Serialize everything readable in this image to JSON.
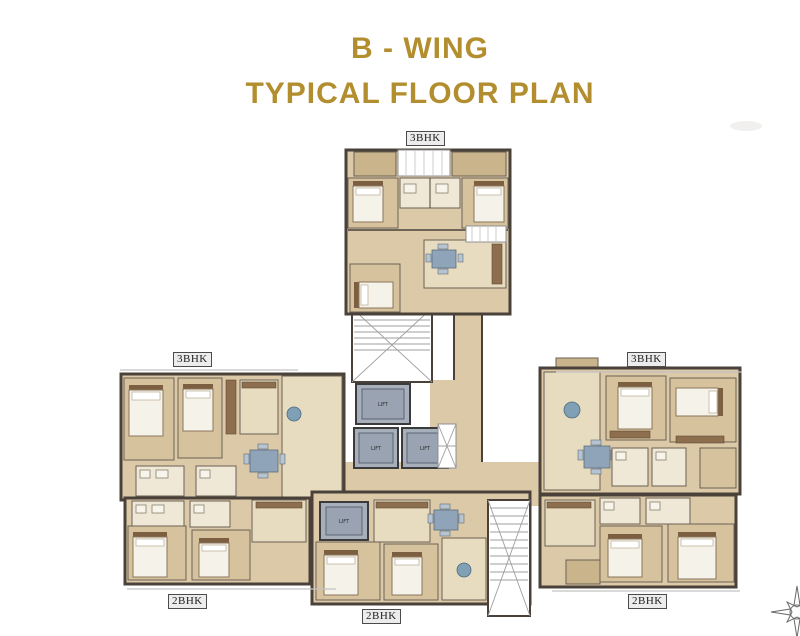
{
  "title": {
    "line1": "B - WING",
    "line2": "TYPICAL FLOOR PLAN",
    "color": "#B28E2E"
  },
  "plan": {
    "units": [
      {
        "key": "top",
        "type_label": "3BHK"
      },
      {
        "key": "left",
        "type_label": "3BHK"
      },
      {
        "key": "right",
        "type_label": "3BHK"
      },
      {
        "key": "bottom_left",
        "type_label": "2BHK"
      },
      {
        "key": "bottom_center",
        "type_label": "2BHK"
      },
      {
        "key": "bottom_right",
        "type_label": "2BHK"
      }
    ],
    "core": {
      "lift_label": "LIFT",
      "lift_count": 4,
      "staircase_count": 2
    },
    "compass": "compass-rose",
    "colors": {
      "title_gold": "#B28E2E",
      "wall": "#4a423a",
      "floor_beige": "#dcc9a7",
      "floor_light": "#e8dcc0",
      "bedroom_tan": "#d7c29e",
      "balcony_tan": "#c9b48c",
      "lift_gray": "#a7afbb",
      "accent_blue": "#7fa0b5",
      "background": "#ffffff"
    }
  }
}
